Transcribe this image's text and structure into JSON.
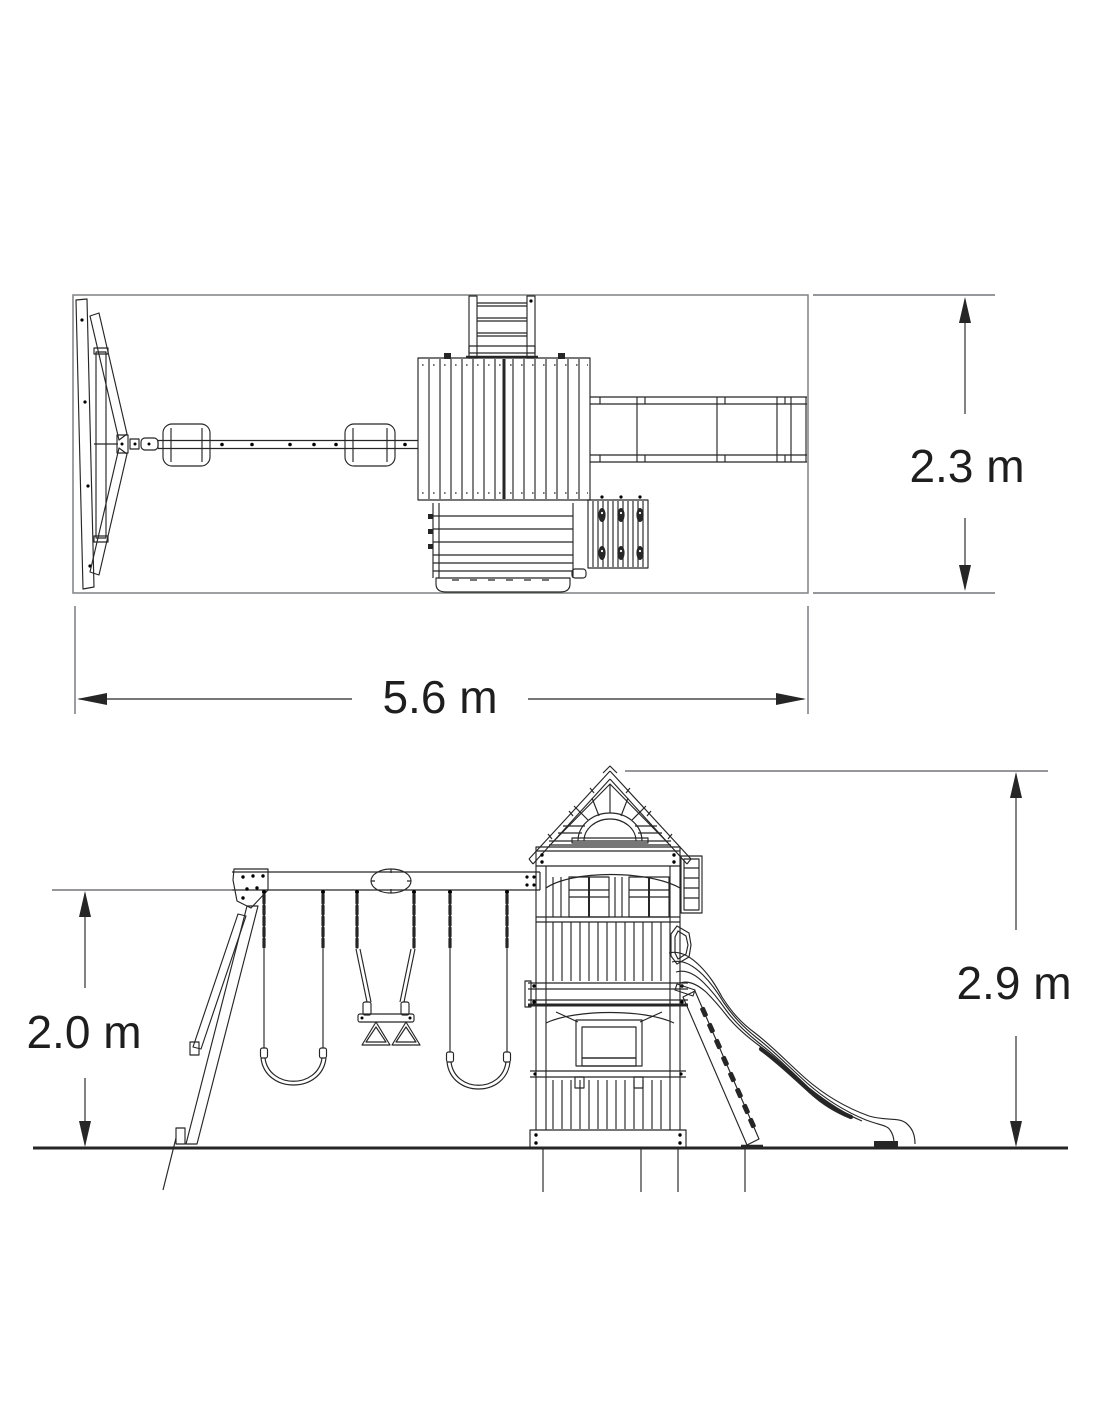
{
  "figure": {
    "background": "#ffffff",
    "ink_color": "#262626",
    "guide_line_color": "#95979a"
  },
  "dimensions": {
    "plan": {
      "depth": "2.3 m",
      "width": "5.6 m"
    },
    "elevation": {
      "swing_beam_height": "2.0 m",
      "overall_height": "2.9 m"
    }
  }
}
